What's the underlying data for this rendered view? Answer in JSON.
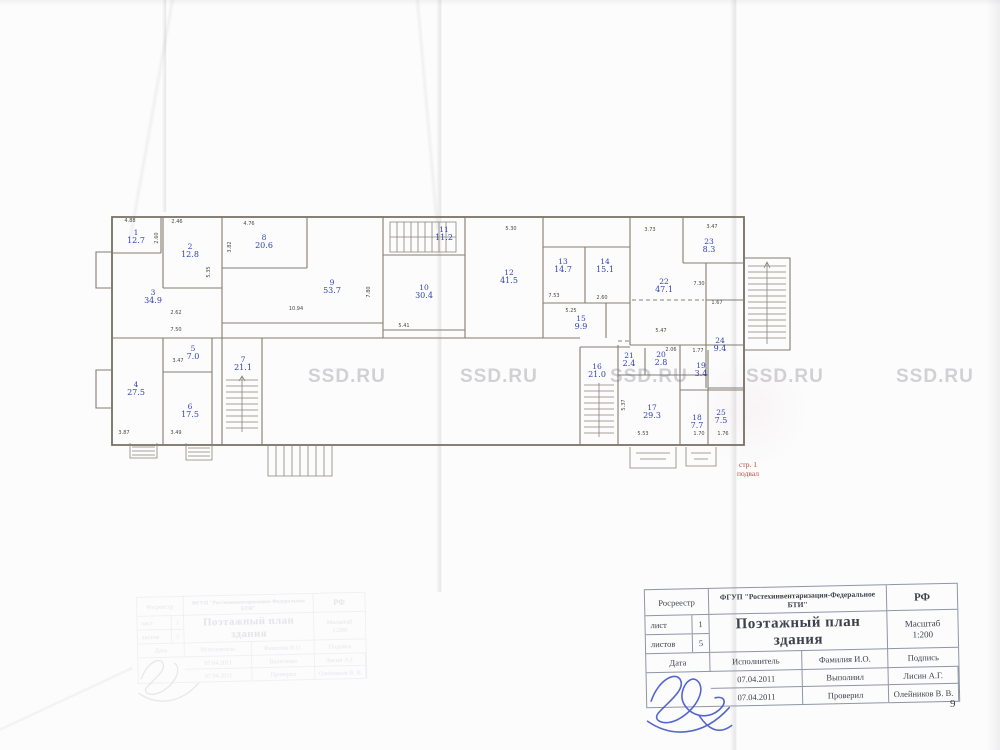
{
  "watermark": {
    "text": "SSD.RU",
    "positions": [
      {
        "x": 308,
        "y": 366
      },
      {
        "x": 460,
        "y": 366
      },
      {
        "x": 610,
        "y": 366
      },
      {
        "x": 746,
        "y": 366
      },
      {
        "x": 896,
        "y": 366
      }
    ]
  },
  "page": {
    "number": "9"
  },
  "red_note": {
    "line1": "стр. 1",
    "line2": "подвал",
    "color": "#c8423a"
  },
  "plan": {
    "label_color": "#3242b2",
    "rooms": [
      {
        "n": "1",
        "a": "12.7",
        "x": 136,
        "y": 237
      },
      {
        "n": "2",
        "a": "12.8",
        "x": 190,
        "y": 251
      },
      {
        "n": "3",
        "a": "34.9",
        "x": 153,
        "y": 297
      },
      {
        "n": "4",
        "a": "27.5",
        "x": 136,
        "y": 389
      },
      {
        "n": "5",
        "a": "7.0",
        "x": 193,
        "y": 353
      },
      {
        "n": "6",
        "a": "17.5",
        "x": 190,
        "y": 411
      },
      {
        "n": "7",
        "a": "21.1",
        "x": 243,
        "y": 364
      },
      {
        "n": "8",
        "a": "20.6",
        "x": 264,
        "y": 242
      },
      {
        "n": "9",
        "a": "53.7",
        "x": 332,
        "y": 287
      },
      {
        "n": "10",
        "a": "30.4",
        "x": 424,
        "y": 292
      },
      {
        "n": "11",
        "a": "11.2",
        "x": 444,
        "y": 234
      },
      {
        "n": "12",
        "a": "41.5",
        "x": 509,
        "y": 277
      },
      {
        "n": "13",
        "a": "14.7",
        "x": 563,
        "y": 266
      },
      {
        "n": "14",
        "a": "15.1",
        "x": 605,
        "y": 266
      },
      {
        "n": "15",
        "a": "9.9",
        "x": 581,
        "y": 323
      },
      {
        "n": "16",
        "a": "21.0",
        "x": 597,
        "y": 371
      },
      {
        "n": "17",
        "a": "29.3",
        "x": 652,
        "y": 412
      },
      {
        "n": "18",
        "a": "7.7",
        "x": 697,
        "y": 422
      },
      {
        "n": "19",
        "a": "3.4",
        "x": 701,
        "y": 370
      },
      {
        "n": "20",
        "a": "2.8",
        "x": 661,
        "y": 359
      },
      {
        "n": "21",
        "a": "2.4",
        "x": 629,
        "y": 360
      },
      {
        "n": "22",
        "a": "47.1",
        "x": 664,
        "y": 286
      },
      {
        "n": "23",
        "a": "8.3",
        "x": 709,
        "y": 246
      },
      {
        "n": "24",
        "a": "9.4",
        "x": 720,
        "y": 345
      },
      {
        "n": "25",
        "a": "7.5",
        "x": 721,
        "y": 417
      }
    ],
    "dims": [
      {
        "t": "4.88",
        "x": 130,
        "y": 221
      },
      {
        "t": "2.46",
        "x": 177,
        "y": 222
      },
      {
        "t": "4.76",
        "x": 249,
        "y": 224
      },
      {
        "t": "2.60",
        "x": 157,
        "y": 238,
        "v": 1
      },
      {
        "t": "3.82",
        "x": 230,
        "y": 247,
        "v": 1
      },
      {
        "t": "5.35",
        "x": 209,
        "y": 272,
        "v": 1
      },
      {
        "t": "10.94",
        "x": 296,
        "y": 309
      },
      {
        "t": "7.80",
        "x": 369,
        "y": 292,
        "v": 1
      },
      {
        "t": "5.41",
        "x": 404,
        "y": 326
      },
      {
        "t": "2.62",
        "x": 176,
        "y": 313
      },
      {
        "t": "7.50",
        "x": 176,
        "y": 330
      },
      {
        "t": "3.47",
        "x": 178,
        "y": 361
      },
      {
        "t": "3.49",
        "x": 176,
        "y": 433
      },
      {
        "t": "3.87",
        "x": 124,
        "y": 433
      },
      {
        "t": "5.30",
        "x": 511,
        "y": 229
      },
      {
        "t": "7.53",
        "x": 554,
        "y": 296
      },
      {
        "t": "2.60",
        "x": 602,
        "y": 298
      },
      {
        "t": "5.25",
        "x": 571,
        "y": 311
      },
      {
        "t": "3.73",
        "x": 650,
        "y": 230
      },
      {
        "t": "3.47",
        "x": 712,
        "y": 227
      },
      {
        "t": "7.30",
        "x": 699,
        "y": 284
      },
      {
        "t": "5.47",
        "x": 661,
        "y": 331
      },
      {
        "t": "1.67",
        "x": 717,
        "y": 303
      },
      {
        "t": "2.06",
        "x": 671,
        "y": 350
      },
      {
        "t": "1.77",
        "x": 698,
        "y": 351
      },
      {
        "t": "5.53",
        "x": 643,
        "y": 434
      },
      {
        "t": "1.70",
        "x": 699,
        "y": 434
      },
      {
        "t": "1.76",
        "x": 723,
        "y": 434
      },
      {
        "t": "5.37",
        "x": 624,
        "y": 405,
        "v": 1
      }
    ]
  },
  "title_block": {
    "registry": "Росреестр",
    "org": "ФГУП \"Ростехинвентаризация-Федеральное БТИ\"",
    "rf": "РФ",
    "sheet_label": "лист",
    "sheet_value": "1",
    "sheets_label": "листов",
    "sheets_value": "5",
    "title": "Поэтажный план здания",
    "scale_label": "Масштаб",
    "scale_value": "1:200",
    "date_label": "Дата",
    "executor_label": "Исполнитель",
    "name_label": "Фамилия И.О.",
    "signature_label": "Подпись",
    "rows": [
      {
        "date": "07.04.2011",
        "role": "Выполнил",
        "name": "Лисин А.Г."
      },
      {
        "date": "07.04.2011",
        "role": "Проверил",
        "name": "Олейников В. В."
      }
    ]
  }
}
